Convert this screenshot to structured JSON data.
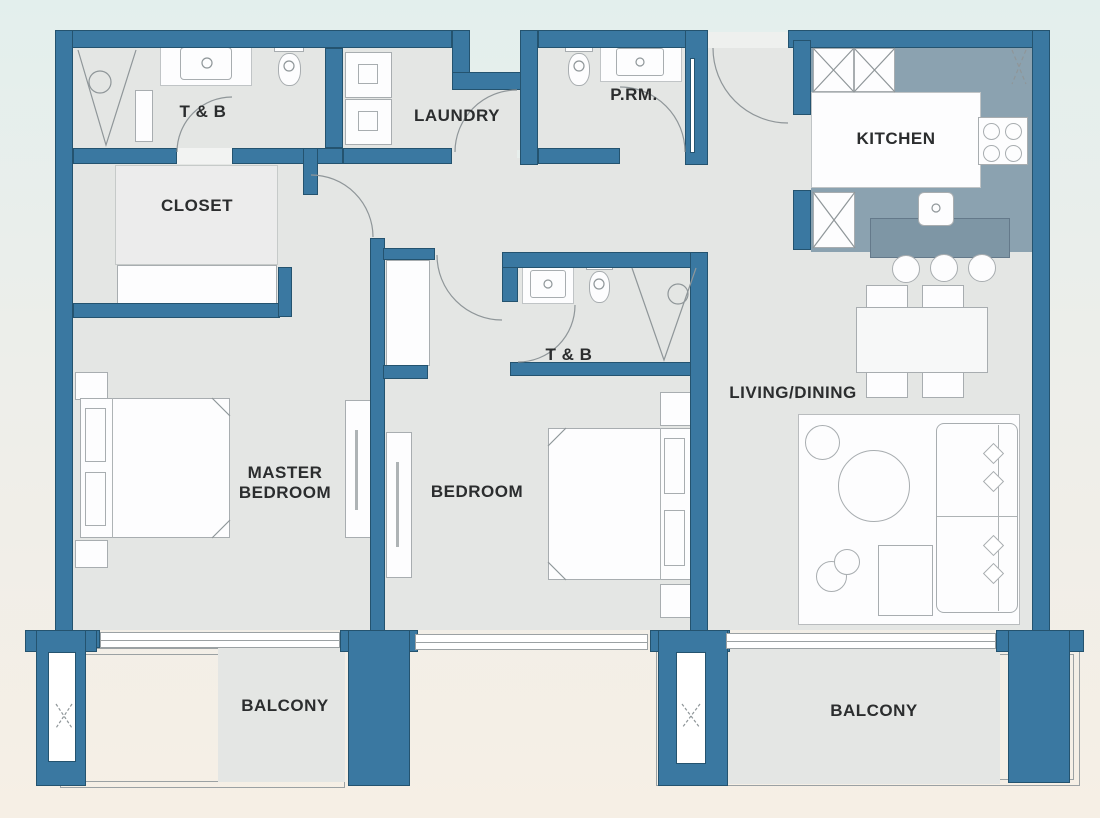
{
  "plan": {
    "colors": {
      "wall": "#3a78a1",
      "wall_edge": "#24536f",
      "floor": "#e4e6e4",
      "floor_light": "#ececec",
      "kitchen_floor": "#8ba2b0",
      "island": "#7e96a5",
      "background_top": "#e3efed",
      "background_bottom": "#f6efe5",
      "label": "#2b2d2e",
      "white": "#fdfdfe"
    },
    "rooms": [
      {
        "id": "tb1",
        "label": "T & B"
      },
      {
        "id": "closet",
        "label": "CLOSET"
      },
      {
        "id": "laundry",
        "label": "LAUNDRY"
      },
      {
        "id": "prm",
        "label": "P.RM."
      },
      {
        "id": "kitchen",
        "label": "KITCHEN"
      },
      {
        "id": "tb2",
        "label": "T & B"
      },
      {
        "id": "master",
        "label": "MASTER BEDROOM",
        "line1": "MASTER",
        "line2": "BEDROOM"
      },
      {
        "id": "bedroom",
        "label": "BEDROOM"
      },
      {
        "id": "living",
        "label": "LIVING/DINING"
      },
      {
        "id": "balcony1",
        "label": "BALCONY"
      },
      {
        "id": "balcony2",
        "label": "BALCONY"
      }
    ],
    "fixtures": [
      "shower",
      "vanity-sink",
      "toilet",
      "washer-dryer",
      "stove",
      "kitchen-island",
      "bar-stool",
      "dining-table",
      "dining-chair",
      "sofa",
      "coffee-table",
      "rug",
      "bed",
      "nightstand",
      "tv-console",
      "wardrobe",
      "column-shaft",
      "door-swing",
      "balcony-railing"
    ]
  }
}
